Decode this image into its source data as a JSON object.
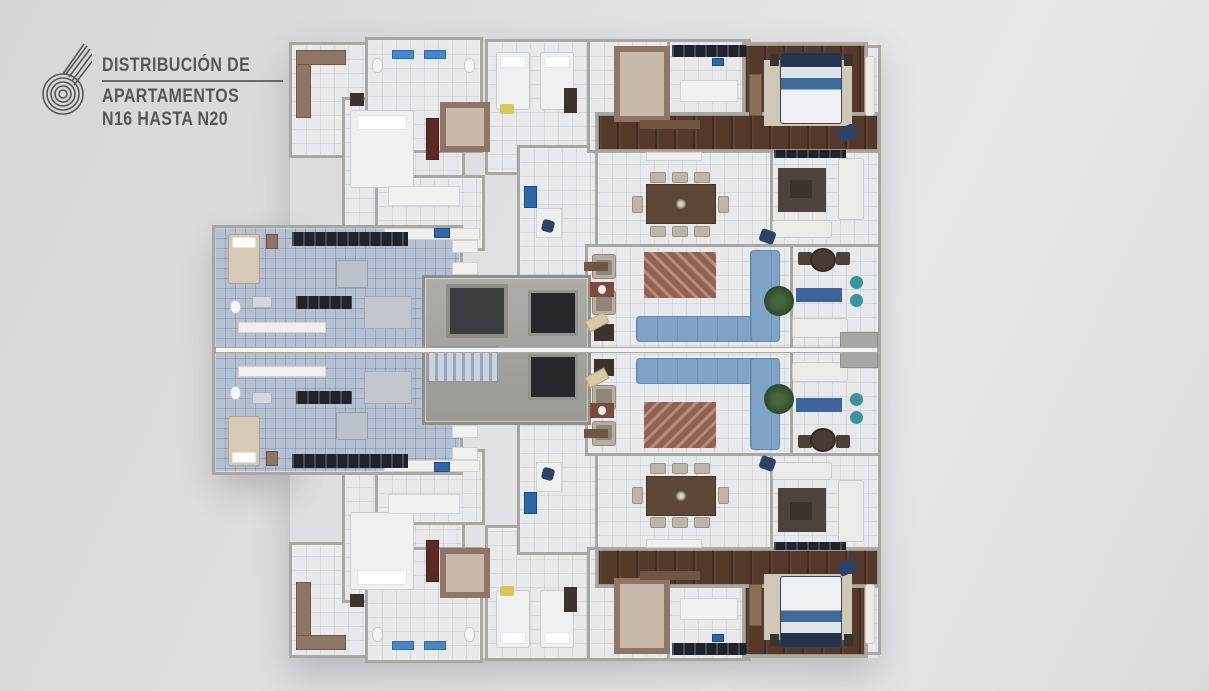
{
  "page_title": "Distribución de Apartamentos N16 hasta N20",
  "logo": {
    "icon": "spiral-drop-icon",
    "title_line1": "DISTRIBUCIÓN DE",
    "title_line2": "APARTAMENTOS",
    "title_line3": "N16 HASTA N20",
    "logo_text": "#56575b"
  },
  "palette": {
    "logo_text": "#56575b",
    "background": "#dedfe1",
    "tile_white": "#e7e9eb",
    "tile_blue": "#b6c0d3",
    "wood": "#54392b",
    "wall": "#a8a7a2",
    "sofa_blue": "#7fa4c8",
    "rug_terracotta": "#95614f",
    "closet_brown": "#8f7566",
    "counter_dark": "#1f242c",
    "appliance_blue": "#2e66a8",
    "plant_green": "#2d4a29",
    "pouf_teal": "#3a949b",
    "bed_navy": "#26334d"
  },
  "plan": {
    "mirror_y": 700,
    "zones": [
      {
        "n": "suite-block-floor",
        "x": 292,
        "y": 45,
        "w": 170,
        "h": 110,
        "f": "tw",
        "s": 1
      },
      {
        "n": "front-bedroom-floor",
        "x": 345,
        "y": 100,
        "w": 117,
        "h": 147,
        "f": "tw",
        "s": 1
      },
      {
        "n": "bath-corridor-floor",
        "x": 368,
        "y": 40,
        "w": 112,
        "h": 110,
        "f": "tw",
        "s": 1
      },
      {
        "n": "twin-bedroom-floor",
        "x": 488,
        "y": 42,
        "w": 102,
        "h": 130,
        "f": "tw",
        "s": 1
      },
      {
        "n": "kitchen-secondary-floor",
        "x": 378,
        "y": 178,
        "w": 104,
        "h": 70,
        "f": "tw",
        "s": 1
      },
      {
        "n": "foyer-floor",
        "x": 520,
        "y": 148,
        "w": 82,
        "h": 202,
        "f": "tw",
        "s": 1
      },
      {
        "n": "walkin-closet-floor",
        "x": 590,
        "y": 42,
        "w": 83,
        "h": 108,
        "f": "tw",
        "s": 1
      },
      {
        "n": "kitchen-main-floor",
        "x": 670,
        "y": 42,
        "w": 78,
        "h": 108,
        "f": "tw",
        "s": 1
      },
      {
        "n": "edge-balcony-floor",
        "x": 862,
        "y": 48,
        "w": 16,
        "h": 98,
        "f": "tw",
        "s": 1
      },
      {
        "n": "tv-lounge-floor",
        "x": 770,
        "y": 150,
        "w": 108,
        "h": 97,
        "f": "tw",
        "s": 1
      },
      {
        "n": "dining-room-floor",
        "x": 598,
        "y": 150,
        "w": 172,
        "h": 97,
        "f": "tw",
        "s": 1
      },
      {
        "n": "terrace-floor",
        "x": 790,
        "y": 247,
        "w": 88,
        "h": 103,
        "f": "tw",
        "s": 1
      },
      {
        "n": "living-room-floor",
        "x": 588,
        "y": 247,
        "w": 202,
        "h": 103,
        "f": "tw",
        "s": 1
      },
      {
        "n": "master-bedroom-floor",
        "x": 745,
        "y": 45,
        "w": 120,
        "h": 103,
        "f": "wd",
        "s": 1
      },
      {
        "n": "wood-hallway-floor",
        "x": 598,
        "y": 115,
        "w": 280,
        "h": 35,
        "f": "wd",
        "s": 1
      },
      {
        "n": "service-wing-floor",
        "x": 215,
        "y": 228,
        "w": 245,
        "h": 244,
        "f": "tb",
        "s": 0
      },
      {
        "n": "core-floor",
        "x": 425,
        "y": 278,
        "w": 163,
        "h": 144,
        "f": "cc",
        "s": 0
      }
    ],
    "items": [
      {
        "n": "corner-closet-v",
        "t": "ward",
        "x": 296,
        "y": 50,
        "w": 15,
        "h": 68,
        "s": 1
      },
      {
        "n": "corner-closet-h",
        "t": "ward",
        "x": 296,
        "y": 50,
        "w": 50,
        "h": 15,
        "s": 1
      },
      {
        "n": "front-bed",
        "t": "bedw",
        "x": 350,
        "y": 110,
        "w": 64,
        "h": 78,
        "s": 1
      },
      {
        "n": "front-bed-bench",
        "t": "dark",
        "x": 350,
        "y": 93,
        "w": 14,
        "h": 13,
        "s": 1
      },
      {
        "n": "dresser-red",
        "t": "dred",
        "x": 426,
        "y": 118,
        "w": 13,
        "h": 42,
        "s": 1
      },
      {
        "n": "closet-u-small",
        "t": "wardu",
        "x": 440,
        "y": 102,
        "w": 50,
        "h": 50,
        "s": 1
      },
      {
        "n": "toilet-1",
        "t": "wc",
        "x": 372,
        "y": 58,
        "w": 11,
        "h": 15,
        "s": 1
      },
      {
        "n": "vanity-1",
        "t": "sinkb",
        "x": 392,
        "y": 50,
        "w": 22,
        "h": 9,
        "s": 1
      },
      {
        "n": "vanity-2",
        "t": "sinkb",
        "x": 424,
        "y": 50,
        "w": 22,
        "h": 9,
        "s": 1
      },
      {
        "n": "toilet-2",
        "t": "wc",
        "x": 464,
        "y": 58,
        "w": 11,
        "h": 15,
        "s": 1
      },
      {
        "n": "twin-bed-1",
        "t": "bedw",
        "x": 496,
        "y": 52,
        "w": 34,
        "h": 58,
        "s": 1
      },
      {
        "n": "twin-bed-2",
        "t": "bedw",
        "x": 540,
        "y": 52,
        "w": 34,
        "h": 58,
        "s": 1
      },
      {
        "n": "yellow-cushion",
        "t": "ypil",
        "x": 500,
        "y": 104,
        "w": 14,
        "h": 10,
        "s": 1
      },
      {
        "n": "twin-dresser",
        "t": "dark",
        "x": 564,
        "y": 88,
        "w": 13,
        "h": 25,
        "s": 1
      },
      {
        "n": "closet-u-main",
        "t": "wardu",
        "x": 614,
        "y": 46,
        "w": 56,
        "h": 76,
        "s": 1
      },
      {
        "n": "kitchen-counter",
        "t": "kdark",
        "x": 672,
        "y": 45,
        "w": 74,
        "h": 12,
        "s": 1
      },
      {
        "n": "kitchen-island",
        "t": "islw",
        "x": 680,
        "y": 80,
        "w": 58,
        "h": 22,
        "s": 1
      },
      {
        "n": "kitchen-appliance",
        "t": "appb",
        "x": 712,
        "y": 58,
        "w": 12,
        "h": 8,
        "s": 1
      },
      {
        "n": "master-rug",
        "t": "rugb",
        "x": 764,
        "y": 60,
        "w": 88,
        "h": 66,
        "s": 1
      },
      {
        "n": "master-bed",
        "t": "bedm",
        "x": 780,
        "y": 52,
        "w": 62,
        "h": 72,
        "s": 1
      },
      {
        "n": "master-nightstand-1",
        "t": "dark",
        "x": 770,
        "y": 54,
        "w": 9,
        "h": 12,
        "s": 1
      },
      {
        "n": "master-nightstand-2",
        "t": "dark",
        "x": 844,
        "y": 54,
        "w": 9,
        "h": 12,
        "s": 1
      },
      {
        "n": "master-desk",
        "t": "desk",
        "x": 749,
        "y": 74,
        "w": 13,
        "h": 42,
        "s": 1
      },
      {
        "n": "master-chair",
        "t": "chnav",
        "x": 838,
        "y": 126,
        "w": 18,
        "h": 14,
        "r": -25,
        "s": 1
      },
      {
        "n": "hall-console",
        "t": "console",
        "x": 640,
        "y": 120,
        "w": 60,
        "h": 9,
        "s": 1
      },
      {
        "n": "dining-sideboard",
        "t": "slight",
        "x": 646,
        "y": 152,
        "w": 56,
        "h": 9,
        "s": 1
      },
      {
        "n": "dining-table",
        "t": "tbl",
        "x": 646,
        "y": 184,
        "w": 70,
        "h": 40,
        "s": 1
      },
      {
        "n": "dining-chair-1",
        "t": "ch",
        "x": 650,
        "y": 172,
        "w": 16,
        "h": 11,
        "s": 1
      },
      {
        "n": "dining-chair-2",
        "t": "ch",
        "x": 672,
        "y": 172,
        "w": 16,
        "h": 11,
        "s": 1
      },
      {
        "n": "dining-chair-3",
        "t": "ch",
        "x": 694,
        "y": 172,
        "w": 16,
        "h": 11,
        "s": 1
      },
      {
        "n": "dining-chair-4",
        "t": "ch",
        "x": 650,
        "y": 226,
        "w": 16,
        "h": 11,
        "s": 1
      },
      {
        "n": "dining-chair-5",
        "t": "ch",
        "x": 672,
        "y": 226,
        "w": 16,
        "h": 11,
        "s": 1
      },
      {
        "n": "dining-chair-6",
        "t": "ch",
        "x": 694,
        "y": 226,
        "w": 16,
        "h": 11,
        "s": 1
      },
      {
        "n": "dining-chair-7",
        "t": "ch",
        "x": 632,
        "y": 196,
        "w": 11,
        "h": 17,
        "s": 1
      },
      {
        "n": "dining-chair-8",
        "t": "ch",
        "x": 718,
        "y": 196,
        "w": 11,
        "h": 17,
        "s": 1
      },
      {
        "n": "tv-console",
        "t": "kdark",
        "x": 774,
        "y": 150,
        "w": 72,
        "h": 8,
        "s": 1
      },
      {
        "n": "lounge-rug",
        "t": "rugd",
        "x": 778,
        "y": 168,
        "w": 48,
        "h": 44,
        "s": 1
      },
      {
        "n": "lounge-coffee-table",
        "t": "dark",
        "x": 790,
        "y": 180,
        "w": 22,
        "h": 18,
        "s": 1
      },
      {
        "n": "lounge-sofa-right",
        "t": "sofw",
        "x": 838,
        "y": 158,
        "w": 26,
        "h": 62,
        "s": 1
      },
      {
        "n": "lounge-sofa-bottom",
        "t": "sofw",
        "x": 772,
        "y": 220,
        "w": 60,
        "h": 18,
        "s": 1
      },
      {
        "n": "lounge-chair-navy",
        "t": "chnav",
        "x": 760,
        "y": 230,
        "w": 15,
        "h": 13,
        "r": 20,
        "s": 1
      },
      {
        "n": "living-armchair-1",
        "t": "cha",
        "x": 592,
        "y": 254,
        "w": 24,
        "h": 25,
        "s": 1
      },
      {
        "n": "living-armchair-2",
        "t": "cha",
        "x": 592,
        "y": 290,
        "w": 24,
        "h": 25,
        "s": 1
      },
      {
        "n": "living-side-table",
        "t": "dark",
        "x": 594,
        "y": 324,
        "w": 20,
        "h": 17,
        "s": 1
      },
      {
        "n": "living-rug",
        "t": "rugr",
        "x": 644,
        "y": 252,
        "w": 72,
        "h": 46,
        "s": 1
      },
      {
        "n": "sofa-long",
        "t": "sofb",
        "x": 636,
        "y": 316,
        "w": 124,
        "h": 26,
        "s": 1
      },
      {
        "n": "sofa-chaise",
        "t": "sofb",
        "x": 750,
        "y": 250,
        "w": 30,
        "h": 92,
        "s": 1
      },
      {
        "n": "living-plant",
        "t": "plant",
        "x": 764,
        "y": 286,
        "w": 30,
        "h": 30,
        "s": 1
      },
      {
        "n": "terrace-chair-1",
        "t": "chd",
        "x": 798,
        "y": 252,
        "w": 14,
        "h": 13,
        "s": 1
      },
      {
        "n": "terrace-chair-2",
        "t": "chd",
        "x": 836,
        "y": 252,
        "w": 14,
        "h": 13,
        "s": 1
      },
      {
        "n": "terrace-table",
        "t": "tblr",
        "x": 810,
        "y": 248,
        "w": 26,
        "h": 24,
        "s": 1
      },
      {
        "n": "terrace-mat",
        "t": "matb",
        "x": 796,
        "y": 288,
        "w": 46,
        "h": 14,
        "s": 1
      },
      {
        "n": "terrace-pouf-1",
        "t": "pouf",
        "x": 850,
        "y": 276,
        "w": 13,
        "h": 13,
        "s": 1
      },
      {
        "n": "terrace-pouf-2",
        "t": "pouf",
        "x": 850,
        "y": 294,
        "w": 13,
        "h": 13,
        "s": 1
      },
      {
        "n": "terrace-lounge",
        "t": "sofw",
        "x": 792,
        "y": 318,
        "w": 56,
        "h": 20,
        "s": 1
      },
      {
        "n": "terrace-divider",
        "t": "gray",
        "x": 840,
        "y": 332,
        "w": 38,
        "h": 36,
        "s": 0
      },
      {
        "n": "edge-lounge",
        "t": "sofw",
        "x": 865,
        "y": 56,
        "w": 10,
        "h": 60,
        "s": 1
      },
      {
        "n": "island-2",
        "t": "islw",
        "x": 388,
        "y": 186,
        "w": 72,
        "h": 20,
        "s": 1
      },
      {
        "n": "counter-2",
        "t": "slight",
        "x": 384,
        "y": 228,
        "w": 96,
        "h": 12,
        "s": 1
      },
      {
        "n": "stove-blue",
        "t": "appb",
        "x": 434,
        "y": 228,
        "w": 16,
        "h": 10,
        "s": 1
      },
      {
        "n": "fridge-blue",
        "t": "appb",
        "x": 524,
        "y": 186,
        "w": 13,
        "h": 22,
        "s": 1
      },
      {
        "n": "den-desk",
        "t": "slight",
        "x": 536,
        "y": 208,
        "w": 26,
        "h": 30,
        "s": 1
      },
      {
        "n": "den-chair",
        "t": "chnav",
        "x": 542,
        "y": 220,
        "w": 12,
        "h": 12,
        "r": 15,
        "s": 1
      },
      {
        "n": "foyer-console",
        "t": "console",
        "x": 584,
        "y": 262,
        "w": 24,
        "h": 9,
        "s": 1
      },
      {
        "n": "foyer-bench",
        "t": "chbg",
        "x": 586,
        "y": 316,
        "w": 22,
        "h": 12,
        "r": -28,
        "s": 1
      },
      {
        "n": "service-bed",
        "t": "bedb",
        "x": 228,
        "y": 234,
        "w": 32,
        "h": 50,
        "s": 1
      },
      {
        "n": "service-nightstand",
        "t": "ward",
        "x": 266,
        "y": 234,
        "w": 12,
        "h": 15,
        "s": 1
      },
      {
        "n": "service-counter",
        "t": "kdark",
        "x": 292,
        "y": 232,
        "w": 116,
        "h": 14,
        "s": 1
      },
      {
        "n": "service-counter-2",
        "t": "kdark",
        "x": 296,
        "y": 296,
        "w": 56,
        "h": 13,
        "s": 1
      },
      {
        "n": "service-table",
        "t": "tbls",
        "x": 336,
        "y": 260,
        "w": 32,
        "h": 28,
        "s": 1
      },
      {
        "n": "service-toilet",
        "t": "wc",
        "x": 230,
        "y": 300,
        "w": 11,
        "h": 14,
        "s": 1
      },
      {
        "n": "service-sink",
        "t": "shower",
        "x": 252,
        "y": 296,
        "w": 20,
        "h": 12,
        "s": 1
      },
      {
        "n": "laundry-shelf-1",
        "t": "slight",
        "x": 238,
        "y": 322,
        "w": 88,
        "h": 11,
        "s": 0
      },
      {
        "n": "laundry-shelf-2",
        "t": "slight",
        "x": 238,
        "y": 366,
        "w": 88,
        "h": 11,
        "s": 0
      },
      {
        "n": "laundry-unit",
        "t": "grayl",
        "x": 364,
        "y": 296,
        "w": 48,
        "h": 33,
        "s": 1
      },
      {
        "n": "closet-niche-1",
        "t": "slight",
        "x": 452,
        "y": 240,
        "w": 26,
        "h": 13,
        "s": 1
      },
      {
        "n": "closet-niche-2",
        "t": "slight",
        "x": 452,
        "y": 262,
        "w": 26,
        "h": 13,
        "s": 1
      },
      {
        "n": "closet-niche-3",
        "t": "slight",
        "x": 452,
        "y": 284,
        "w": 26,
        "h": 13,
        "s": 0
      },
      {
        "n": "stairwell",
        "t": "pit",
        "x": 446,
        "y": 284,
        "w": 62,
        "h": 54,
        "s": 0
      },
      {
        "n": "elevator-1",
        "t": "elev",
        "x": 528,
        "y": 290,
        "w": 50,
        "h": 46,
        "s": 0
      },
      {
        "n": "elevator-2",
        "t": "elev",
        "x": 528,
        "y": 354,
        "w": 50,
        "h": 46,
        "s": 0
      },
      {
        "n": "stair-flight",
        "t": "stairs",
        "x": 428,
        "y": 346,
        "w": 70,
        "h": 36,
        "s": 0
      },
      {
        "n": "lobby-mat",
        "t": "matr",
        "x": 590,
        "y": 282,
        "w": 24,
        "h": 15,
        "s": 1
      },
      {
        "n": "party-wall",
        "t": "wall",
        "x": 215,
        "y": 347,
        "w": 663,
        "h": 6,
        "s": 0
      }
    ]
  }
}
